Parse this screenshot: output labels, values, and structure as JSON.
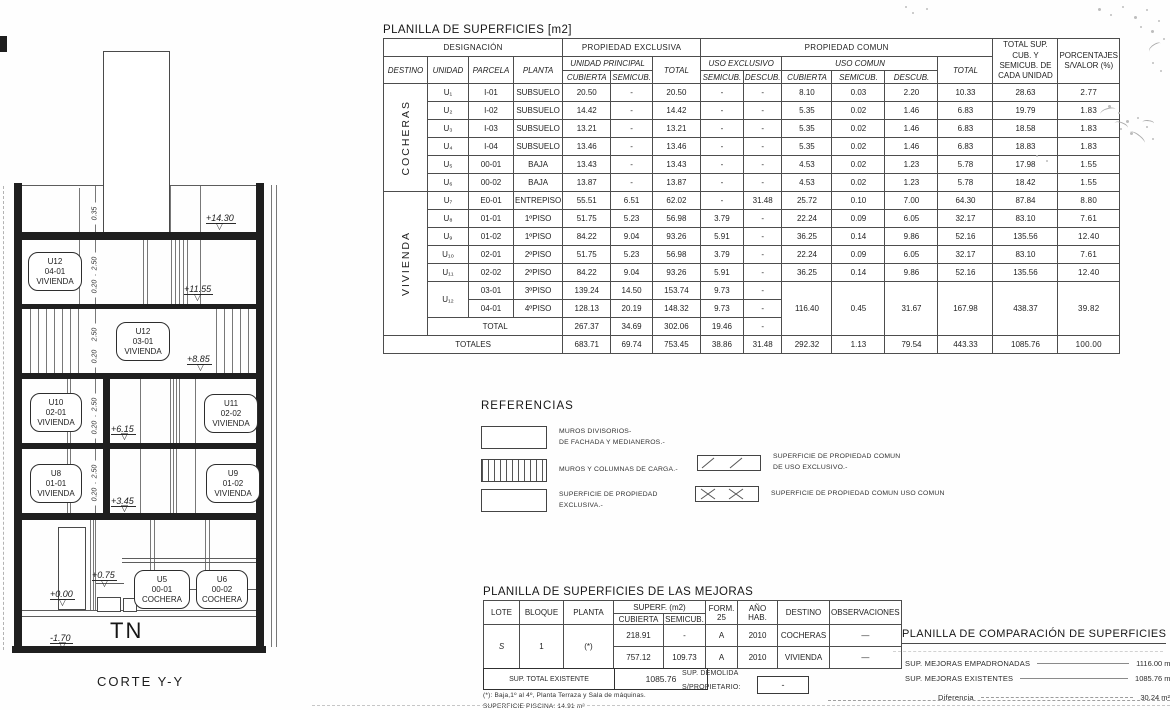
{
  "main_table": {
    "title": "PLANILLA DE SUPERFICIES [m2]",
    "headers": {
      "designacion": "DESIGNACIÓN",
      "prop_exclusiva": "PROPIEDAD EXCLUSIVA",
      "prop_comun": "PROPIEDAD COMUN",
      "total_sup": "TOTAL SUP. CUB. Y SEMICUB. DE CADA UNIDAD",
      "porcentajes": "PORCENTAJES S/VALOR (%)",
      "destino": "DESTINO",
      "unidad": "UNIDAD",
      "parcela": "PARCELA",
      "planta": "PLANTA",
      "unidad_principal": "UNIDAD PRINCIPAL",
      "uso_exclusivo": "USO EXCLUSIVO",
      "uso_comun": "USO COMUN",
      "total": "TOTAL",
      "cubierta": "CUBIERTA",
      "semicub": "SEMICUB.",
      "descub": "DESCUB."
    },
    "groups": [
      {
        "destino": "COCHERAS",
        "rows": [
          [
            "U₁",
            "I-01",
            "SUBSUELO",
            "20.50",
            "-",
            "20.50",
            "-",
            "-",
            "8.10",
            "0.03",
            "2.20",
            "10.33",
            "28.63",
            "2.77"
          ],
          [
            "U₂",
            "I-02",
            "SUBSUELO",
            "14.42",
            "-",
            "14.42",
            "-",
            "-",
            "5.35",
            "0.02",
            "1.46",
            "6.83",
            "19.79",
            "1.83"
          ],
          [
            "U₃",
            "I-03",
            "SUBSUELO",
            "13.21",
            "-",
            "13.21",
            "-",
            "-",
            "5.35",
            "0.02",
            "1.46",
            "6.83",
            "18.58",
            "1.83"
          ],
          [
            "U₄",
            "I-04",
            "SUBSUELO",
            "13.46",
            "-",
            "13.46",
            "-",
            "-",
            "5.35",
            "0.02",
            "1.46",
            "6.83",
            "18.83",
            "1.83"
          ],
          [
            "U₅",
            "00-01",
            "BAJA",
            "13.43",
            "-",
            "13.43",
            "-",
            "-",
            "4.53",
            "0.02",
            "1.23",
            "5.78",
            "17.98",
            "1.55"
          ],
          [
            "U₆",
            "00-02",
            "BAJA",
            "13.87",
            "-",
            "13.87",
            "-",
            "-",
            "4.53",
            "0.02",
            "1.23",
            "5.78",
            "18.42",
            "1.55"
          ]
        ]
      },
      {
        "destino": "VIVIENDA",
        "rows": [
          [
            "U₇",
            "E0-01",
            "ENTREPISO",
            "55.51",
            "6.51",
            "62.02",
            "-",
            "31.48",
            "25.72",
            "0.10",
            "7.00",
            "64.30",
            "87.84",
            "8.80"
          ],
          [
            "U₈",
            "01-01",
            "1ºPISO",
            "51.75",
            "5.23",
            "56.98",
            "3.79",
            "-",
            "22.24",
            "0.09",
            "6.05",
            "32.17",
            "83.10",
            "7.61"
          ],
          [
            "U₉",
            "01-02",
            "1ºPISO",
            "84.22",
            "9.04",
            "93.26",
            "5.91",
            "-",
            "36.25",
            "0.14",
            "9.86",
            "52.16",
            "135.56",
            "12.40"
          ],
          [
            "U₁₀",
            "02-01",
            "2ºPISO",
            "51.75",
            "5.23",
            "56.98",
            "3.79",
            "-",
            "22.24",
            "0.09",
            "6.05",
            "32.17",
            "83.10",
            "7.61"
          ],
          [
            "U₁₁",
            "02-02",
            "2ºPISO",
            "84.22",
            "9.04",
            "93.26",
            "5.91",
            "-",
            "36.25",
            "0.14",
            "9.86",
            "52.16",
            "135.56",
            "12.40"
          ]
        ],
        "u12": {
          "unidad": "U₁₂",
          "subrows": [
            [
              "03-01",
              "3ºPISO",
              "139.24",
              "14.50",
              "153.74",
              "9.73",
              "-"
            ],
            [
              "04-01",
              "4ºPISO",
              "128.13",
              "20.19",
              "148.32",
              "9.73",
              "-"
            ]
          ],
          "merged": [
            "116.40",
            "0.45",
            "31.67",
            "167.98",
            "438.37",
            "39.82"
          ]
        },
        "total_row": {
          "label": "TOTAL",
          "values": [
            "267.37",
            "34.69",
            "302.06",
            "19.46",
            "-"
          ]
        }
      }
    ],
    "totales_row": {
      "label": "TOTALES",
      "values": [
        "683.71",
        "69.74",
        "753.45",
        "38.86",
        "31.48",
        "292.32",
        "1.13",
        "79.54",
        "443.33",
        "1085.76",
        "100.00"
      ]
    }
  },
  "referencias": {
    "title": "REFERENCIAS",
    "items": [
      {
        "swatch": "plain-swatch",
        "lines": [
          "MUROS DIVISORIOS-",
          "DE FACHADA Y MEDIANEROS.-"
        ]
      },
      {
        "swatch": "vhatch-swatch",
        "lines": [
          "MUROS Y COLUMNAS DE CARGA.-"
        ]
      },
      {
        "swatch": "plain-swatch",
        "lines": [
          "SUPERFICIE DE PROPIEDAD",
          "EXCLUSIVA.-"
        ]
      },
      {
        "swatch": "diagonal-hatch-swatch",
        "lines": [
          "SUPERFICIE DE PROPIEDAD COMUN",
          "DE USO EXCLUSIVO.-"
        ]
      },
      {
        "swatch": "cross-hatch-swatch",
        "lines": [
          "SUPERFICIE DE PROPIEDAD COMUN USO COMUN"
        ]
      }
    ]
  },
  "mejoras": {
    "title": "PLANILLA DE SUPERFICIES DE LAS MEJORAS",
    "headers": {
      "lote": "LOTE",
      "bloque": "BLOQUE",
      "planta": "PLANTA",
      "superf": "SUPERF. (m2)",
      "cubierta": "CUBIERTA",
      "semicub": "SEMICUB.",
      "form25": "FORM. 25",
      "ano_hab": "AÑO HAB.",
      "destino": "DESTINO",
      "observaciones": "OBSERVACIONES"
    },
    "lote": "S",
    "bloque": "1",
    "planta": "(*)",
    "rows": [
      {
        "cubierta": "218.91",
        "semicub": "-",
        "form": "A",
        "ano": "2010",
        "destino": "COCHERAS",
        "obs": "—"
      },
      {
        "cubierta": "757.12",
        "semicub": "109.73",
        "form": "A",
        "ano": "2010",
        "destino": "VIVIENDA",
        "obs": "—"
      }
    ],
    "total_label": "SUP. TOTAL EXISTENTE",
    "total_value": "1085.76",
    "demolida_label": "SUP. DEMOLIDA",
    "propietario_label": "S/PROPIETARIO:",
    "propietario_value": "-",
    "footnote1": "(*): Baja,1º al 4º, Planta Terraza y Sala de máquinas.",
    "footnote2": "SUPERFICIE PISCINA: 14.91 m²"
  },
  "comparacion": {
    "title": "PLANILLA DE COMPARACIÓN DE SUPERFICIES",
    "rows": [
      {
        "label": "SUP. MEJORAS EMPADRONADAS",
        "value": "1116.00 m²"
      },
      {
        "label": "SUP. MEJORAS EXISTENTES",
        "value": "1085.76 m²"
      },
      {
        "label": "Diferencia",
        "value": "30.24 m²"
      }
    ]
  },
  "drawing": {
    "caption": "CORTE Y-Y",
    "terrain_label": "TN",
    "levels": [
      "+14.30",
      "+11.55",
      "+8.85",
      "+6.15",
      "+3.45",
      "+0.75",
      "+0.00",
      "-1.70"
    ],
    "dims": [
      "0.35",
      "2.50",
      "0.20",
      "2.50",
      "0.20",
      "2.50",
      "0.20",
      "2.50",
      "0.20"
    ],
    "units": [
      {
        "unit": "U12",
        "parcel": "04-01",
        "use": "VIVIENDA"
      },
      {
        "unit": "U12",
        "parcel": "03-01",
        "use": "VIVIENDA"
      },
      {
        "unit": "U10",
        "parcel": "02-01",
        "use": "VIVIENDA"
      },
      {
        "unit": "U11",
        "parcel": "02-02",
        "use": "VIVIENDA"
      },
      {
        "unit": "U8",
        "parcel": "01-01",
        "use": "VIVIENDA"
      },
      {
        "unit": "U9",
        "parcel": "01-02",
        "use": "VIVIENDA"
      },
      {
        "unit": "U5",
        "parcel": "00-01",
        "use": "COCHERA"
      },
      {
        "unit": "U6",
        "parcel": "00-02",
        "use": "COCHERA"
      }
    ]
  }
}
